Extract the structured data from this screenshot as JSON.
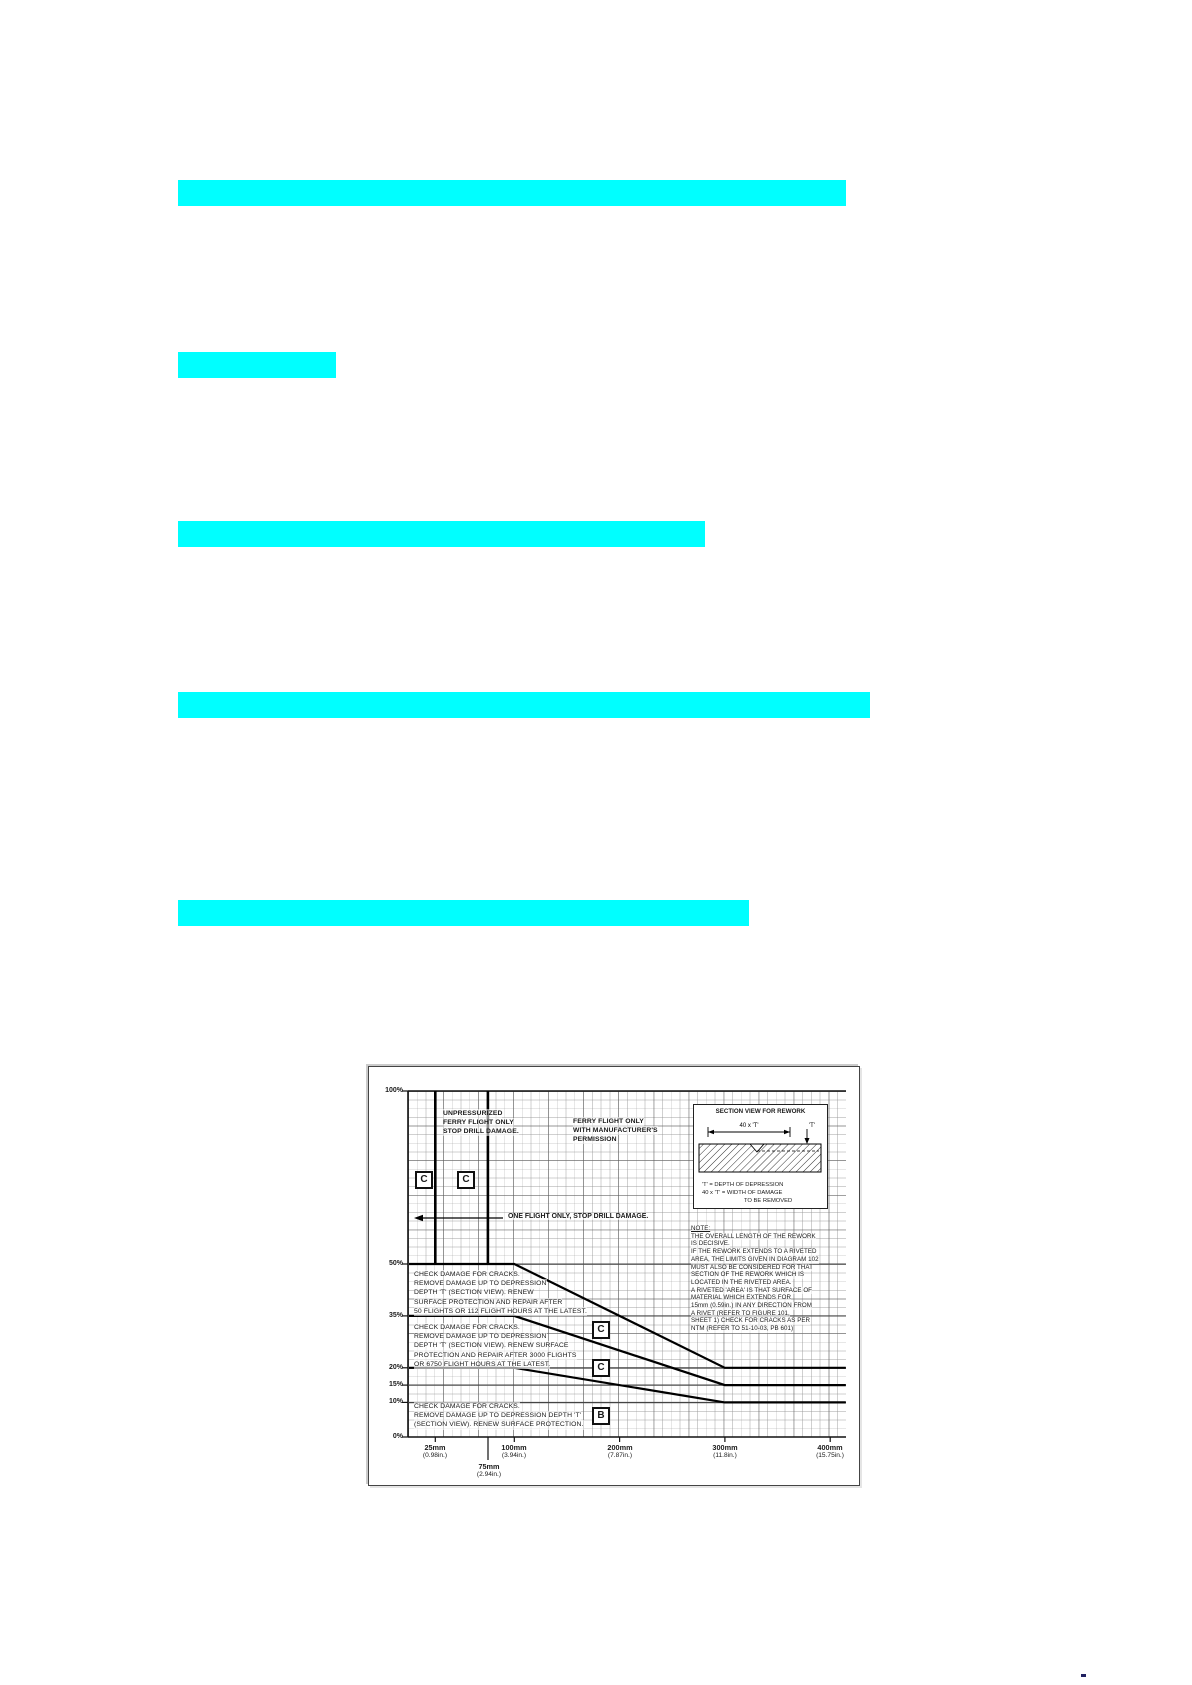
{
  "page": {
    "background": "#ffffff",
    "highlight_color": "#00ffff",
    "highlight_bar_count": 5
  },
  "figure": {
    "y_axis": {
      "labels": [
        "100%",
        "50%",
        "35%",
        "20%",
        "15%",
        "10%",
        "0%"
      ]
    },
    "x_axis": {
      "ticks": [
        {
          "mm": "25mm",
          "in": "(0.98in.)"
        },
        {
          "mm": "100mm",
          "in": "(3.94in.)"
        },
        {
          "mm": "200mm",
          "in": "(7.87in.)"
        },
        {
          "mm": "300mm",
          "in": "(11.8in.)"
        },
        {
          "mm": "400mm",
          "in": "(15.75in.)"
        },
        {
          "mm": "75mm",
          "in": "(2.94in.)"
        }
      ]
    },
    "zones": {
      "unpressurized": {
        "lines": [
          "UNPRESSURIZED",
          "FERRY FLIGHT ONLY",
          "STOP DRILL DAMAGE."
        ]
      },
      "ferry": {
        "lines": [
          "FERRY FLIGHT ONLY",
          "WITH MANUFACTURER'S",
          "PERMISSION"
        ]
      },
      "one_flight": "ONE FLIGHT ONLY, STOP DRILL DAMAGE."
    },
    "blocks": {
      "b1": {
        "lines": [
          "CHECK DAMAGE FOR CRACKS.",
          "REMOVE DAMAGE UP TO DEPRESSION",
          "DEPTH 'T' (SECTION VIEW). RENEW",
          "SURFACE PROTECTION AND REPAIR AFTER",
          "50 FLIGHTS OR 112 FLIGHT HOURS AT THE LATEST."
        ]
      },
      "b2": {
        "lines": [
          "CHECK DAMAGE FOR CRACKS.",
          "REMOVE DAMAGE UP TO DEPRESSION",
          "DEPTH 'T' (SECTION VIEW). RENEW SURFACE",
          "PROTECTION AND REPAIR AFTER 3000 FLIGHTS",
          "OR 6750 FLIGHT HOURS AT THE LATEST."
        ]
      },
      "b3": {
        "lines": [
          "CHECK DAMAGE FOR CRACKS.",
          "REMOVE DAMAGE UP TO DEPRESSION DEPTH 'T'",
          "(SECTION VIEW). RENEW SURFACE PROTECTION."
        ]
      }
    },
    "note": {
      "lines": [
        "NOTE:",
        "THE OVERALL LENGTH OF THE REWORK",
        "IS DECISIVE.",
        "IF THE REWORK EXTENDS TO A RIVETED",
        "AREA, THE LIMITS GIVEN IN DIAGRAM 102",
        "MUST ALSO BE CONSIDERED FOR THAT",
        "SECTION OF THE REWORK WHICH IS",
        "LOCATED IN THE RIVETED AREA.",
        "A RIVETED 'AREA' IS THAT SURFACE OF",
        "MATERIAL WHICH EXTENDS FOR",
        "15mm (0.59in.) IN ANY DIRECTION FROM",
        "A RIVET (REFER TO FIGURE 101,",
        "SHEET 1) CHECK FOR CRACKS AS PER",
        "NTM (REFER TO 51-10-03, PB 601)"
      ]
    },
    "callouts": [
      "C",
      "C",
      "C",
      "C",
      "B"
    ],
    "inset": {
      "title": "SECTION VIEW FOR REWORK",
      "dim_label": "40 x 'T'",
      "t_label": "'T'",
      "legend": [
        "'T'  =  DEPTH OF DEPRESSION",
        "40 x 'T'  =  WIDTH OF DAMAGE",
        "TO BE REMOVED"
      ]
    }
  },
  "chart_data": {
    "type": "line",
    "x_range_mm": [
      0,
      415
    ],
    "y_range_percent": [
      0,
      100
    ],
    "x_tick_values_mm": [
      25,
      75,
      100,
      200,
      300,
      400
    ],
    "y_tick_values_percent": [
      0,
      10,
      15,
      20,
      35,
      50,
      100
    ],
    "grid": "fine engineering grid, on",
    "boundary_lines_mm": [
      25,
      75
    ],
    "series": [
      {
        "name": "C - repair after 50 flights or 112 flight hours",
        "callout": "C",
        "points_mm_pct": [
          [
            0,
            50
          ],
          [
            100,
            50
          ],
          [
            300,
            20
          ],
          [
            415,
            20
          ]
        ]
      },
      {
        "name": "C - repair after 3000 flights or 6750 flight hours",
        "callout": "C",
        "points_mm_pct": [
          [
            0,
            35
          ],
          [
            100,
            35
          ],
          [
            300,
            15
          ],
          [
            415,
            15
          ]
        ]
      },
      {
        "name": "B - renew surface protection",
        "callout": "B",
        "points_mm_pct": [
          [
            0,
            20
          ],
          [
            100,
            20
          ],
          [
            300,
            10
          ],
          [
            415,
            10
          ]
        ]
      }
    ],
    "annotations": [
      "UNPRESSURIZED FERRY FLIGHT ONLY STOP DRILL DAMAGE.",
      "FERRY FLIGHT ONLY WITH MANUFACTURER'S PERMISSION",
      "ONE FLIGHT ONLY, STOP DRILL DAMAGE."
    ]
  }
}
